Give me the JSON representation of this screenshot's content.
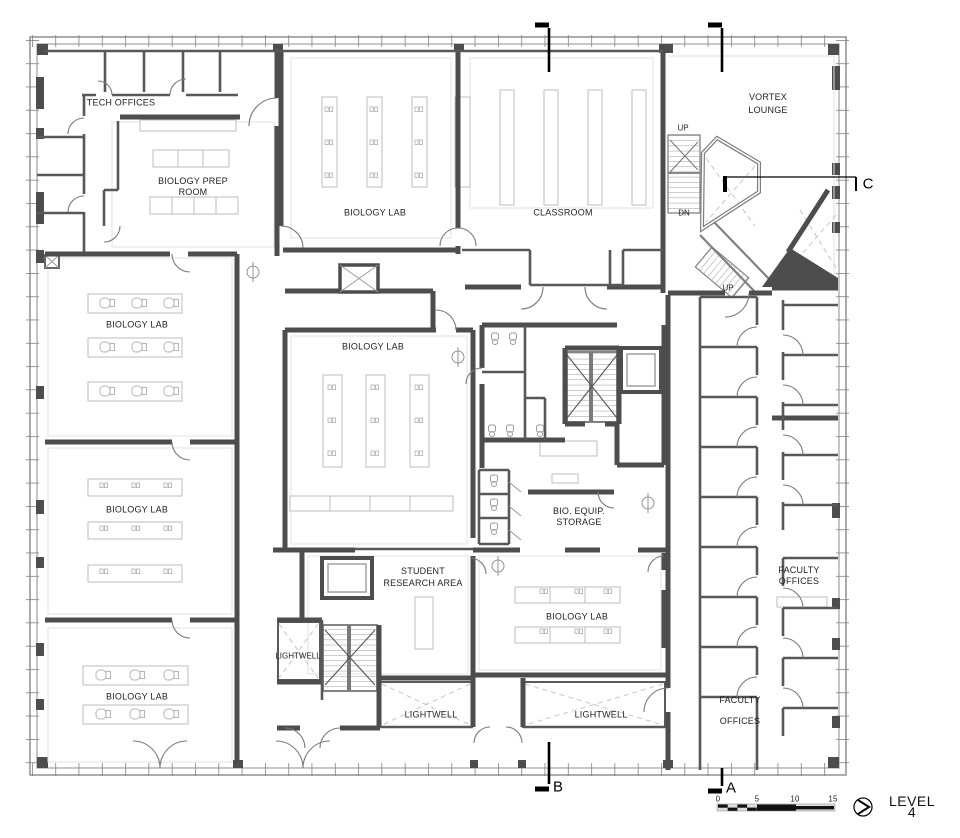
{
  "rooms": {
    "tech_offices": "TECH OFFICES",
    "biology_prep_room": "BIOLOGY PREP\nROOM",
    "biology_lab_top": "BIOLOGY LAB",
    "classroom": "CLASSROOM",
    "vortex_lounge": "VORTEX\nLOUNGE",
    "biology_lab_left_upper": "BIOLOGY LAB",
    "biology_lab_center": "BIOLOGY LAB",
    "biology_lab_left_middle": "BIOLOGY LAB",
    "bio_equip_storage": "BIO. EQUIP.\nSTORAGE",
    "student_research_area": "STUDENT\nRESEARCH AREA",
    "biology_lab_bottom": "BIOLOGY LAB",
    "biology_lab_left_lower": "BIOLOGY LAB",
    "lightwell_small": "LIGHTWELL",
    "lightwell_center": "LIGHTWELL",
    "lightwell_east": "LIGHTWELL",
    "faculty_offices_east": "FACULTY\nOFFICES",
    "faculty_offices_south": "FACULTY\nOFFICES"
  },
  "stairs": {
    "up_north": "UP",
    "dn_north": "DN",
    "up_south": "UP"
  },
  "section_markers": {
    "a": "A",
    "b": "B",
    "c": "C"
  },
  "scale_bar": {
    "ticks": [
      "0",
      "5",
      "10",
      "15"
    ]
  },
  "level_label": "LEVEL 4",
  "colors": {
    "wall": "#4d4d4d",
    "partition": "#585858",
    "facade": "#7f7f7f",
    "furniture": "#bdbdbd",
    "dashed": "#c6c6c6"
  }
}
